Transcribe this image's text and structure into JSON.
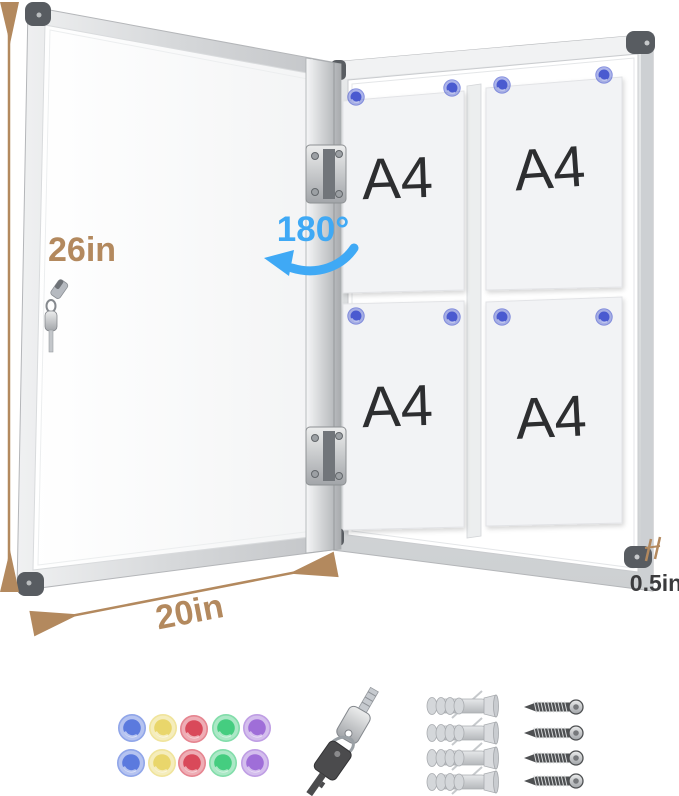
{
  "labels": {
    "height": "26in",
    "width": "20in",
    "depth": "0.5in",
    "open_angle": "180°"
  },
  "papers": [
    {
      "label": "A4"
    },
    {
      "label": "A4"
    },
    {
      "label": "A4"
    },
    {
      "label": "A4"
    }
  ],
  "colors": {
    "dimension_tan": "#b3895e",
    "angle_blue": "#3fa9f5",
    "depth_label": "#3b3b3d",
    "paper_label": "#2d2e30",
    "board_magnet": "#4a5ad0",
    "frame_silver": "#d7d9db",
    "corner_cap": "#585c61",
    "magnet_set": [
      "#5b7ade",
      "#e9d66b",
      "#d9495a",
      "#45cd80",
      "#9f6ed8"
    ]
  },
  "accessories": {
    "magnets": 10,
    "keys": 2,
    "anchors": 4,
    "screws": 4
  }
}
